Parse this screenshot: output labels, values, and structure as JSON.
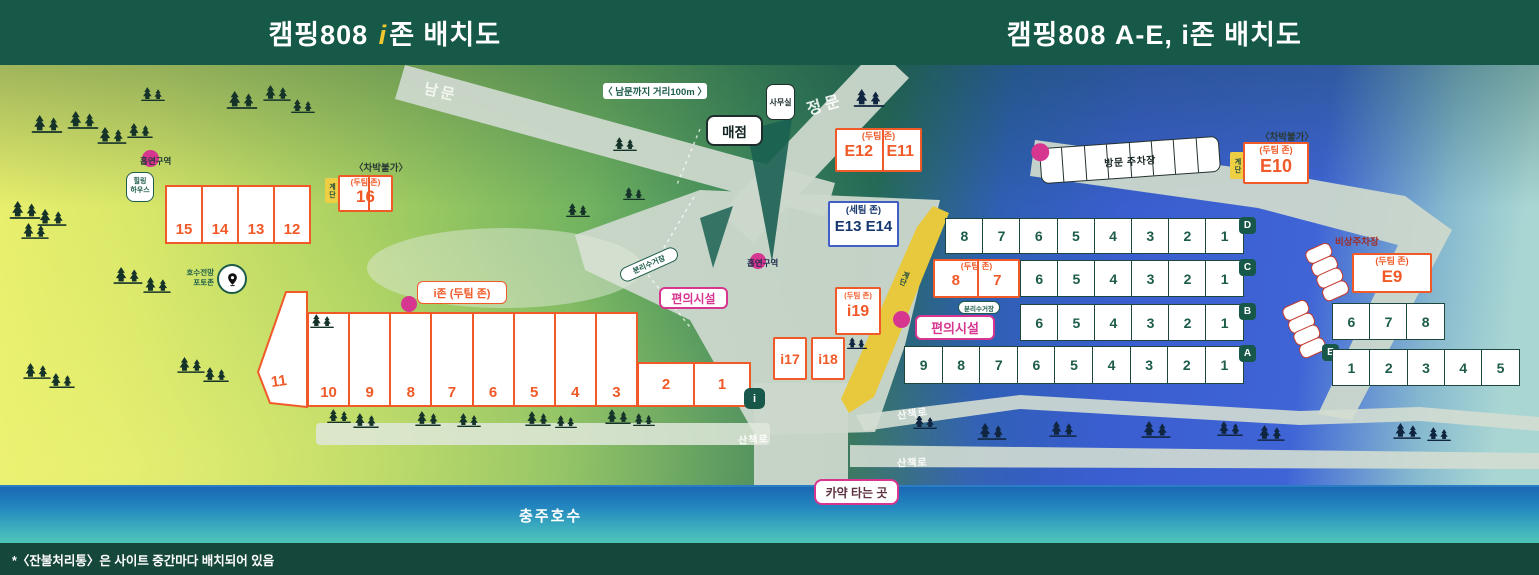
{
  "header": {
    "title_left_prefix": "캠핑808 ",
    "title_left_i": "i",
    "title_left_suffix": "존 배치도",
    "title_right": "캠핑808 A-E, i존 배치도"
  },
  "labels": {
    "south_gate": "남문",
    "main_gate": "정문",
    "distance_note": "〈 남문까지 거리100m 〉",
    "office": "사무실",
    "store": "매점",
    "visitor_parking": "방문 주차장",
    "emergency_parking": "비상주차장",
    "stairs": "계단",
    "no_car_camping": "〈차박불가〉",
    "two_team_zone": "(두팀 존)",
    "three_team_zone": "(세팀 존)",
    "smoking_area": "흡연구역",
    "healing_house": "힐링\n하우스",
    "photo_zone": "호수전망\n포토존",
    "recycling_station": "분리수거장",
    "facilities": "편의시설",
    "izone_label": "i존 (두팀 존)",
    "kayak_spot": "카약 타는 곳",
    "trail": "산책로",
    "lake": "충주호수",
    "footnote": "*〈잔불처리통〉은 사이트 중간마다 배치되어 있음"
  },
  "zones": {
    "row_d": {
      "badge": "D",
      "sites": [
        "8",
        "7",
        "6",
        "5",
        "4",
        "3",
        "2",
        "1"
      ]
    },
    "row_c": {
      "badge": "C",
      "two_team_sites": [
        "8",
        "7"
      ],
      "sites": [
        "6",
        "5",
        "4",
        "3",
        "2",
        "1"
      ]
    },
    "row_b": {
      "badge": "B",
      "sites": [
        "6",
        "5",
        "4",
        "3",
        "2",
        "1"
      ]
    },
    "row_a": {
      "badge": "A",
      "sites": [
        "9",
        "8",
        "7",
        "6",
        "5",
        "4",
        "3",
        "2",
        "1"
      ]
    },
    "row_e": {
      "badge": "E",
      "upper_sites": [
        "6",
        "7",
        "8"
      ],
      "lower_sites": [
        "1",
        "2",
        "3",
        "4",
        "5"
      ]
    },
    "e_sites": {
      "e12": "E12",
      "e11": "E11",
      "e13_e14": "E13 E14",
      "e10": "E10",
      "e9": "E9"
    },
    "i_zone": {
      "badge": "i",
      "site_11": "11",
      "sites_10_3": [
        "10",
        "9",
        "8",
        "7",
        "6",
        "5",
        "4",
        "3"
      ],
      "site_2": "2",
      "site_1": "1",
      "site_16": "16",
      "i17": "i17",
      "i18": "i18",
      "i19": "i19"
    },
    "west_sites": [
      "15",
      "14",
      "13",
      "12"
    ]
  },
  "colors": {
    "header_green": "#175948",
    "accent_orange": "#f05a28",
    "accent_pink": "#d6368f",
    "dark_green": "#1d5c4a",
    "stairs_yellow": "#eecf44",
    "blue_zone_border": "#3f5fc6",
    "lake_blue": "#1a68b4"
  }
}
